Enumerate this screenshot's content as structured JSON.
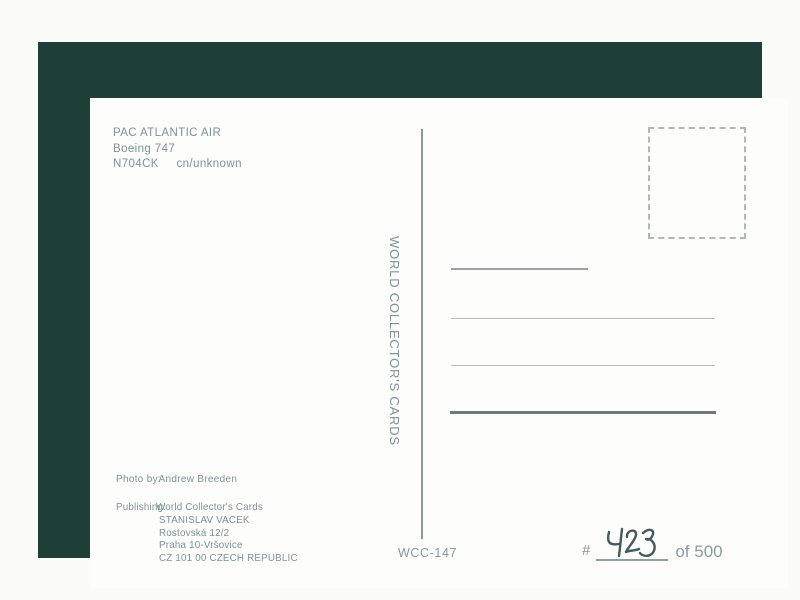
{
  "postcard": {
    "header": {
      "airline": "PAC ATLANTIC AIR",
      "aircraft": "Boeing 747",
      "registration": "N704CK",
      "cn": "cn/unknown"
    },
    "brand": {
      "vertical_text": "WORLD COLLECTOR'S CARDS"
    },
    "photo": {
      "label": "Photo by:",
      "value": "Andrew Breeden"
    },
    "publishing": {
      "label": "Publishing:",
      "lines": [
        "World Collector's Cards",
        "STANISLAV VACEK",
        "Rostovská 12/2",
        "Praha 10-Vršovice",
        "CZ 101 00 CZECH REPUBLIC"
      ]
    },
    "card_number": "WCC-147",
    "serial": {
      "prefix": "#",
      "handwritten_number": "423",
      "suffix": "of 500"
    },
    "colors": {
      "frame_green": "#1e4039",
      "printed_ink": "#7d9396",
      "handwriting_ink": "#46595f"
    }
  }
}
